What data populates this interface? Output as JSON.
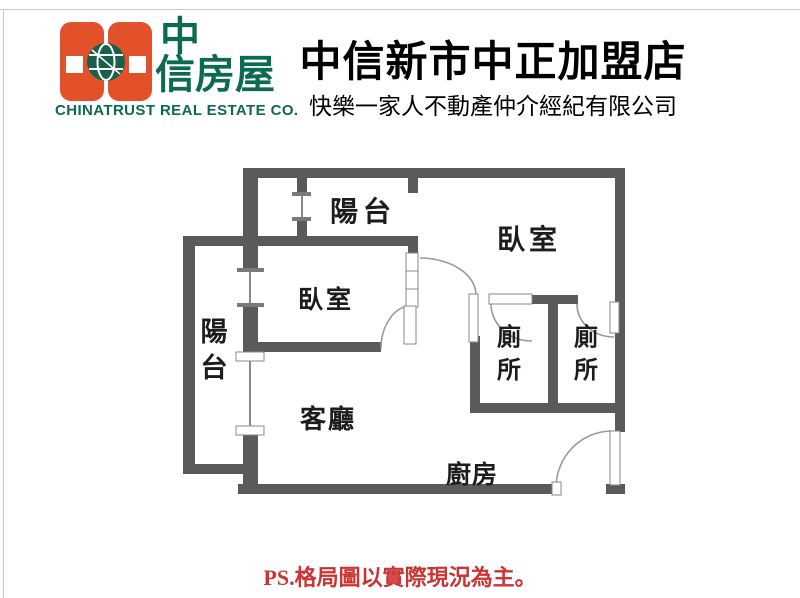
{
  "header": {
    "logo": {
      "brand_line1": "中",
      "brand_line2": "信房屋",
      "company_en": "CHINATRUST REAL ESTATE CO.",
      "brand_red": "#e2512a",
      "brand_green": "#0c6a50"
    },
    "store_title": "中信新市中正加盟店",
    "store_subtitle": "快樂一家人不動產仲介經紀有限公司"
  },
  "plan": {
    "wall_color": "#5a5a5a",
    "line_color": "#999999",
    "labels": {
      "balcony_top": "陽台",
      "bedroom_right": "臥室",
      "bedroom_center": "臥室",
      "balcony_left": "陽台",
      "toilet_left": "廁所",
      "toilet_right": "廁所",
      "living_room": "客廳",
      "kitchen": "廚房"
    }
  },
  "footer": {
    "note": "PS.格局圖以實際現況為主。",
    "note_color": "#cc3333"
  }
}
